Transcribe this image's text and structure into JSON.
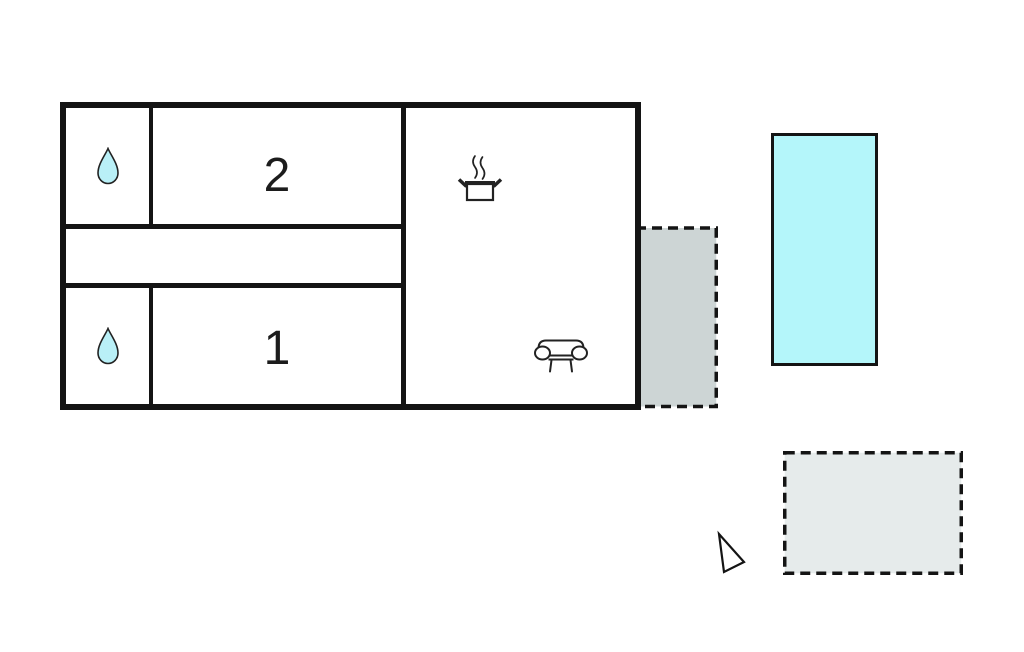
{
  "rooms": {
    "bedroom_2": {
      "label": "2"
    },
    "bedroom_1": {
      "label": "1"
    }
  },
  "icons": {
    "bathroom_top": "water-drop-icon",
    "bathroom_bottom": "water-drop-icon",
    "kitchen": "cooking-pot-steam-icon",
    "living_room": "sofa-icon",
    "orientation": "north-arrow-icon"
  },
  "colors": {
    "wall": "#141414",
    "pool_fill": "#b4f6fa",
    "terrace_attached_fill": "#cdd5d5",
    "terrace_detached_fill": "#e6ebeb",
    "drop_fill": "#b9f0f7",
    "background": "#ffffff",
    "text": "#1c1c1c"
  }
}
